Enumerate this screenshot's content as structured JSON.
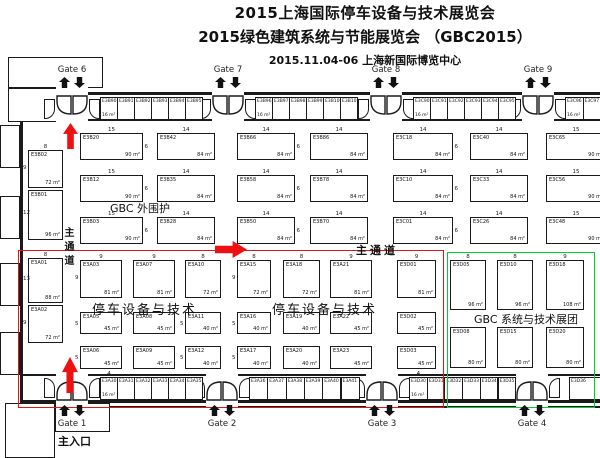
{
  "title": {
    "line1": "2015上海国际停车设备与技术展览会",
    "line2": "2015绿色建筑系统与节能展览会 （GBC2015）",
    "line3": "2015.11.04-06  上海新国际博览中心"
  },
  "colors": {
    "red": "#ee1111",
    "green": "#00cc33",
    "wall": "#1a1a1a"
  },
  "gates": {
    "top": [
      {
        "label": "Gate 6",
        "x": 72
      },
      {
        "label": "Gate 7",
        "x": 228
      },
      {
        "label": "Gate 8",
        "x": 386
      },
      {
        "label": "Gate 9",
        "x": 538
      }
    ],
    "bottom": [
      {
        "label": "Gate 1",
        "x": 72,
        "sub": "主入口"
      },
      {
        "label": "Gate 2",
        "x": 222
      },
      {
        "label": "Gate 3",
        "x": 382
      },
      {
        "label": "Gate 4",
        "x": 532
      }
    ]
  },
  "labels": [
    {
      "text": "GBC 外围护",
      "x": 110,
      "y": 200,
      "cls": "zone-sm"
    },
    {
      "text": "停车设备与技术",
      "x": 92,
      "y": 299,
      "cls": "zone"
    },
    {
      "text": "停车设备与技术",
      "x": 272,
      "y": 299,
      "cls": "zone"
    },
    {
      "text": "GBC 系统与技术",
      "x": 474,
      "y": 311,
      "cls": "zone-sm"
    },
    {
      "text": "展团",
      "x": 556,
      "y": 311,
      "cls": "zone-sm"
    },
    {
      "text": "主通道",
      "x": 356,
      "y": 242,
      "cls": "aisle-h"
    },
    {
      "text": "主通道",
      "x": 60,
      "y": 227,
      "cls": "aisle-v"
    }
  ],
  "arrows": [
    {
      "dir": "up",
      "x": 63,
      "y": 123,
      "w": 15,
      "h": 26
    },
    {
      "dir": "up",
      "x": 62,
      "y": 357,
      "w": 16,
      "h": 36
    },
    {
      "dir": "right",
      "x": 215,
      "y": 241,
      "w": 32,
      "h": 17
    }
  ],
  "booths": [
    {
      "id": "E3B02",
      "x": 28,
      "y": 150,
      "w": 35,
      "h": 38,
      "a": "72 m²",
      "wl": "8",
      "hl": "9",
      "hs": "l"
    },
    {
      "id": "E3B01",
      "x": 28,
      "y": 190,
      "w": 35,
      "h": 50,
      "a": "96 m²",
      "hl": "12",
      "hs": "l"
    },
    {
      "id": "E3B20",
      "x": 80,
      "y": 133,
      "w": 63,
      "h": 27,
      "a": "90 m²",
      "wl": "15",
      "hl": "6",
      "hs": "r"
    },
    {
      "id": "E3B12",
      "x": 80,
      "y": 175,
      "w": 63,
      "h": 27,
      "a": "90 m²",
      "wl": "15",
      "hl": "6",
      "hs": "r"
    },
    {
      "id": "E3B03",
      "x": 80,
      "y": 217,
      "w": 63,
      "h": 27,
      "a": "90 m²",
      "wl": "15",
      "hl": "6",
      "hs": "r"
    },
    {
      "id": "E3B42",
      "x": 157,
      "y": 133,
      "w": 58,
      "h": 27,
      "a": "84 m²",
      "wl": "14"
    },
    {
      "id": "E3B35",
      "x": 157,
      "y": 175,
      "w": 58,
      "h": 27,
      "a": "84 m²",
      "wl": "14"
    },
    {
      "id": "E3B28",
      "x": 157,
      "y": 217,
      "w": 58,
      "h": 27,
      "a": "84 m²",
      "wl": "14"
    },
    {
      "id": "E3B66",
      "x": 237,
      "y": 133,
      "w": 58,
      "h": 27,
      "a": "84 m²",
      "wl": "14",
      "hl": "6",
      "hs": "r"
    },
    {
      "id": "E3B58",
      "x": 237,
      "y": 175,
      "w": 58,
      "h": 27,
      "a": "84 m²",
      "wl": "14",
      "hl": "6",
      "hs": "r"
    },
    {
      "id": "E3B50",
      "x": 237,
      "y": 217,
      "w": 58,
      "h": 27,
      "a": "84 m²",
      "wl": "14",
      "hl": "6",
      "hs": "r"
    },
    {
      "id": "E3B86",
      "x": 310,
      "y": 133,
      "w": 58,
      "h": 27,
      "a": "84 m²",
      "wl": "14"
    },
    {
      "id": "E3B78",
      "x": 310,
      "y": 175,
      "w": 58,
      "h": 27,
      "a": "84 m²",
      "wl": "14"
    },
    {
      "id": "E3B70",
      "x": 310,
      "y": 217,
      "w": 58,
      "h": 27,
      "a": "84 m²",
      "wl": "14"
    },
    {
      "id": "E3C18",
      "x": 393,
      "y": 133,
      "w": 60,
      "h": 27,
      "a": "84 m²",
      "wl": "14",
      "hl": "6",
      "hs": "r"
    },
    {
      "id": "E3C10",
      "x": 393,
      "y": 175,
      "w": 60,
      "h": 27,
      "a": "84 m²",
      "wl": "14",
      "hl": "6",
      "hs": "r"
    },
    {
      "id": "E3C01",
      "x": 393,
      "y": 217,
      "w": 60,
      "h": 27,
      "a": "84 m²",
      "wl": "14",
      "hl": "6",
      "hs": "r"
    },
    {
      "id": "E3C40",
      "x": 470,
      "y": 133,
      "w": 58,
      "h": 27,
      "a": "84 m²",
      "wl": "14"
    },
    {
      "id": "E3C33",
      "x": 470,
      "y": 175,
      "w": 58,
      "h": 27,
      "a": "84 m²",
      "wl": "14"
    },
    {
      "id": "E3C26",
      "x": 470,
      "y": 217,
      "w": 58,
      "h": 27,
      "a": "84 m²",
      "wl": "14"
    },
    {
      "id": "E3C65",
      "x": 546,
      "y": 133,
      "w": 60,
      "h": 27,
      "a": "90 m²",
      "wl": "15"
    },
    {
      "id": "E3C56",
      "x": 546,
      "y": 175,
      "w": 60,
      "h": 27,
      "a": "90 m²",
      "wl": "15"
    },
    {
      "id": "E3C48",
      "x": 546,
      "y": 217,
      "w": 60,
      "h": 27,
      "a": "90 m²",
      "wl": "15"
    },
    {
      "id": "E3A01",
      "x": 28,
      "y": 258,
      "w": 35,
      "h": 45,
      "a": "88 m²",
      "wl": "8",
      "hl": "13",
      "hs": "l"
    },
    {
      "id": "E3A02",
      "x": 28,
      "y": 305,
      "w": 35,
      "h": 38,
      "a": "72 m²",
      "hl": "9",
      "hs": "l"
    },
    {
      "id": "E3A03",
      "x": 80,
      "y": 260,
      "w": 42,
      "h": 38,
      "a": "81 m²",
      "wl": "9",
      "hl": "9",
      "hs": "l"
    },
    {
      "id": "E3A07",
      "x": 133,
      "y": 260,
      "w": 42,
      "h": 38,
      "a": "81 m²",
      "wl": "9"
    },
    {
      "id": "E3A10",
      "x": 185,
      "y": 260,
      "w": 36,
      "h": 38,
      "a": "72 m²",
      "wl": "8"
    },
    {
      "id": "E3A15",
      "x": 237,
      "y": 260,
      "w": 34,
      "h": 38,
      "a": "72 m²",
      "wl": "8",
      "hl": "9",
      "hs": "l"
    },
    {
      "id": "E3A18",
      "x": 283,
      "y": 260,
      "w": 37,
      "h": 38,
      "a": "72 m²",
      "wl": "8"
    },
    {
      "id": "E3A21",
      "x": 330,
      "y": 260,
      "w": 42,
      "h": 38,
      "a": "81 m²",
      "wl": "9"
    },
    {
      "id": "E3D01",
      "x": 397,
      "y": 260,
      "w": 39,
      "h": 38,
      "a": "81 m²",
      "wl": "9"
    },
    {
      "id": "E3A05",
      "x": 80,
      "y": 312,
      "w": 42,
      "h": 22,
      "a": "45 m²",
      "hl": "5",
      "hs": "l"
    },
    {
      "id": "E3A08",
      "x": 133,
      "y": 312,
      "w": 42,
      "h": 22,
      "a": "45 m²"
    },
    {
      "id": "E3A11",
      "x": 185,
      "y": 312,
      "w": 36,
      "h": 22,
      "a": "40 m²",
      "hl": "5",
      "hs": "l"
    },
    {
      "id": "E3A16",
      "x": 237,
      "y": 312,
      "w": 34,
      "h": 22,
      "a": "40 m²",
      "hl": "5",
      "hs": "l"
    },
    {
      "id": "E3A19",
      "x": 283,
      "y": 312,
      "w": 37,
      "h": 22,
      "a": "40 m²"
    },
    {
      "id": "E3A22",
      "x": 330,
      "y": 312,
      "w": 42,
      "h": 22,
      "a": "45 m²"
    },
    {
      "id": "E3D02",
      "x": 397,
      "y": 312,
      "w": 39,
      "h": 22,
      "a": "45 m²"
    },
    {
      "id": "E3A06",
      "x": 80,
      "y": 346,
      "w": 42,
      "h": 23,
      "a": "45 m²",
      "hl": "5",
      "hs": "l"
    },
    {
      "id": "E3A09",
      "x": 133,
      "y": 346,
      "w": 42,
      "h": 23,
      "a": "45 m²"
    },
    {
      "id": "E3A12",
      "x": 185,
      "y": 346,
      "w": 36,
      "h": 23,
      "a": "40 m²",
      "hl": "5",
      "hs": "l"
    },
    {
      "id": "E3A17",
      "x": 237,
      "y": 346,
      "w": 34,
      "h": 23,
      "a": "40 m²",
      "hl": "5",
      "hs": "l"
    },
    {
      "id": "E3A20",
      "x": 283,
      "y": 346,
      "w": 37,
      "h": 23,
      "a": "40 m²"
    },
    {
      "id": "E3A23",
      "x": 330,
      "y": 346,
      "w": 42,
      "h": 23,
      "a": "45 m²"
    },
    {
      "id": "E3D03",
      "x": 397,
      "y": 346,
      "w": 39,
      "h": 23,
      "a": "45 m²"
    },
    {
      "id": "E3D05",
      "x": 450,
      "y": 260,
      "w": 36,
      "h": 50,
      "a": "96 m²",
      "wl": "8"
    },
    {
      "id": "E3D10",
      "x": 497,
      "y": 260,
      "w": 36,
      "h": 50,
      "a": "96 m²",
      "wl": "8"
    },
    {
      "id": "E3D18",
      "x": 546,
      "y": 260,
      "w": 38,
      "h": 50,
      "a": "108 m²",
      "wl": "9"
    },
    {
      "id": "E3D08",
      "x": 450,
      "y": 327,
      "w": 36,
      "h": 41,
      "a": "80 m²"
    },
    {
      "id": "E3D15",
      "x": 497,
      "y": 327,
      "w": 36,
      "h": 41,
      "a": "80 m²"
    },
    {
      "id": "E3D20",
      "x": 546,
      "y": 327,
      "w": 38,
      "h": 41,
      "a": "80 m²"
    }
  ],
  "strips": [
    {
      "x": 100,
      "y": 97,
      "bw": 17,
      "ids": [
        "E3B90",
        "E3B91",
        "E3B92",
        "E3B93",
        "E3B94",
        "E3B95"
      ],
      "area": "16 m²"
    },
    {
      "x": 255,
      "y": 97,
      "bw": 17,
      "ids": [
        "E3B96",
        "E3B97",
        "E3B98",
        "E3B99",
        "E3B100",
        "E3B101"
      ],
      "area": "16 m²"
    },
    {
      "x": 413,
      "y": 97,
      "bw": 17,
      "ids": [
        "E3C90",
        "E3C91",
        "E3C92",
        "E3C93",
        "E3C94",
        "E3C95"
      ],
      "area": "16 m²"
    },
    {
      "x": 565,
      "y": 97,
      "bw": 17.5,
      "ids": [
        "E3C96",
        "E3C97"
      ],
      "area": "16 m²"
    },
    {
      "x": 100,
      "y": 377,
      "bw": 17,
      "ids": [
        "E3A30",
        "E3A31",
        "E3A32",
        "E3A33",
        "E3A34",
        "E3A35"
      ],
      "area": "16 m²",
      "wl": "4"
    },
    {
      "x": 249,
      "y": 377,
      "bw": 18.3,
      "ids": [
        "E3A36",
        "E3A37",
        "E3A38",
        "E3A39",
        "E3A40",
        "E3A41"
      ]
    },
    {
      "x": 409,
      "y": 377,
      "bw": 17.7,
      "ids": [
        "E3D30",
        "E3D31",
        "E3D32",
        "E3D33",
        "E3D34",
        "E3D35"
      ],
      "area": "16 m²",
      "wl": "4"
    },
    {
      "x": 569,
      "y": 377,
      "bw": 31,
      "ids": [
        "E3D36"
      ]
    }
  ]
}
